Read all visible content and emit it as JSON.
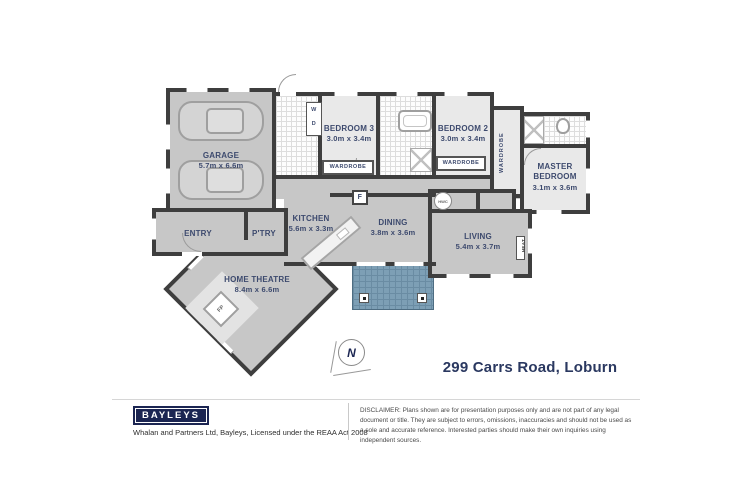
{
  "plan": {
    "rooms": {
      "garage": {
        "name": "GARAGE",
        "dims": "5.7m x 6.6m"
      },
      "bedroom3": {
        "name": "BEDROOM 3",
        "dims": "3.0m x 3.4m"
      },
      "bedroom2": {
        "name": "BEDROOM 2",
        "dims": "3.0m x 3.4m"
      },
      "master": {
        "name": "MASTER BEDROOM",
        "dims": "3.1m x 3.6m"
      },
      "kitchen": {
        "name": "KITCHEN",
        "dims": "5.6m x 3.3m"
      },
      "dining": {
        "name": "DINING",
        "dims": "3.8m x 3.6m"
      },
      "living": {
        "name": "LIVING",
        "dims": "5.4m x 3.7m"
      },
      "home_theatre": {
        "name": "HOME THEATRE",
        "dims": "8.4m x 6.6m"
      },
      "entry": {
        "name": "ENTRY"
      },
      "pantry": {
        "name": "P'TRY"
      }
    },
    "labels": {
      "wardrobe": "WARDROBE",
      "washer": "W",
      "dryer": "D",
      "fridge": "F",
      "hwc": "HWC",
      "heat": "HEAT",
      "fireplace": "FP",
      "north": "N"
    },
    "address": "299 Carrs Road, Loburn"
  },
  "footer": {
    "brand": "BAYLEYS",
    "license": "Whalan and Partners Ltd, Bayleys, Licensed under the REAA Act 2008",
    "disclaimer": "DISCLAIMER: Plans shown are for presentation purposes only and are not part of any legal document or title. They are subject to errors, omissions, inaccuracies and should not be used as a sole and accurate reference. Interested parties should make their own inquiries using independent sources."
  },
  "colors": {
    "wall": "#3e3e3e",
    "floor_open": "#c7c7c7",
    "floor_room": "#e9e9e9",
    "deck": "#7d9fb5",
    "brand_navy": "#1b2552",
    "label_navy": "#3d4a6e"
  }
}
